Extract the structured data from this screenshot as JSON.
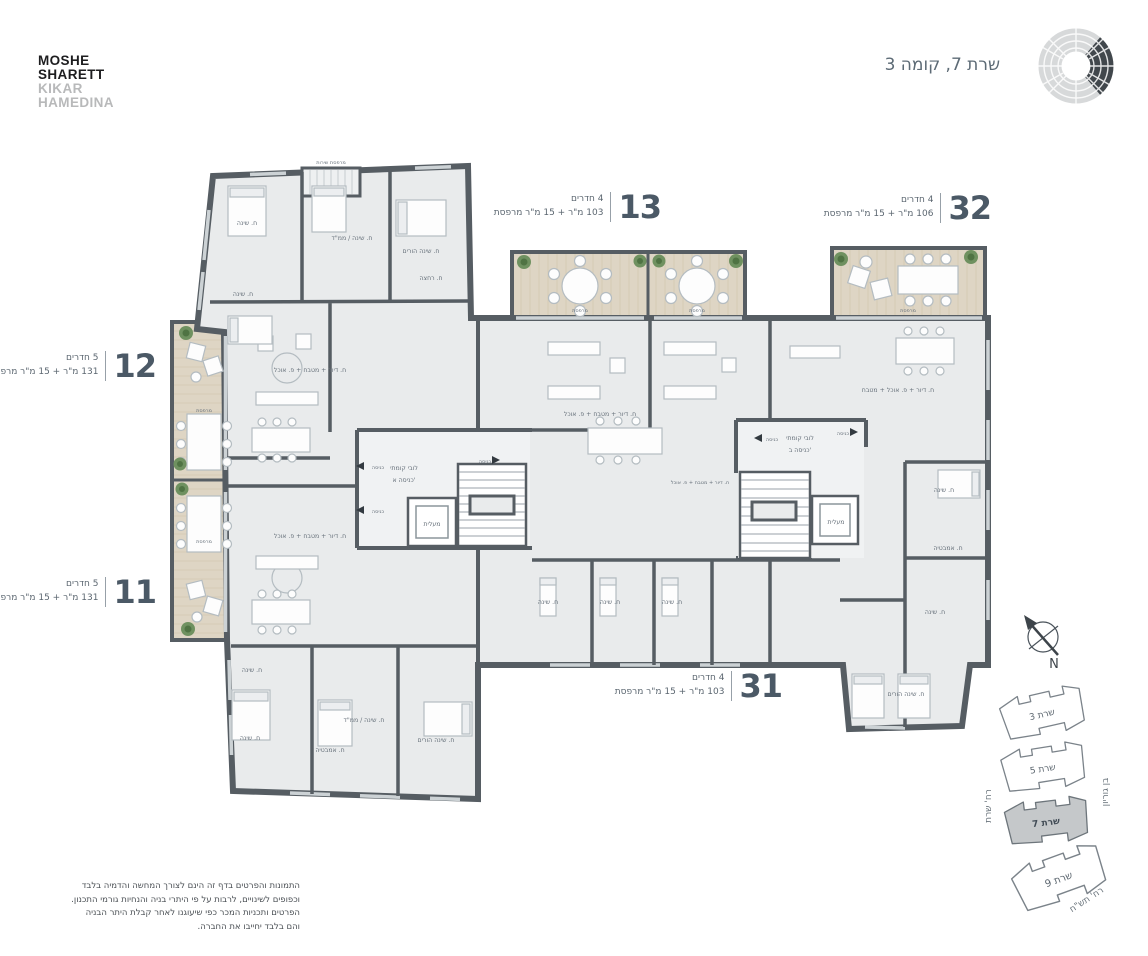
{
  "header": {
    "logo": {
      "line1": "MOSHE",
      "line2": "SHARETT",
      "line3": "KIKAR",
      "line4": "HAMEDINA"
    },
    "floor_title": "שרת 7, קומה 3"
  },
  "units": {
    "u12": {
      "number": "12",
      "rooms": "5 חדרים",
      "area": "131 מ\"ר + 15 מ\"ר מרפסת"
    },
    "u11": {
      "number": "11",
      "rooms": "5 חדרים",
      "area": "131 מ\"ר + 15 מ\"ר מרפסת"
    },
    "u13": {
      "number": "13",
      "rooms": "4 חדרים",
      "area": "103 מ\"ר + 15 מ\"ר מרפסת"
    },
    "u32": {
      "number": "32",
      "rooms": "4 חדרים",
      "area": "106 מ\"ר + 15 מ\"ר מרפסת"
    },
    "u31": {
      "number": "31",
      "rooms": "4 חדרים",
      "area": "103 מ\"ר + 15 מ\"ר מרפסת"
    }
  },
  "plan": {
    "room_labels": [
      {
        "t": "ח. שינה",
        "x": 247,
        "y": 225
      },
      {
        "t": "ח. שינה / ממ\"ד",
        "x": 352,
        "y": 240
      },
      {
        "t": "ח. שינה הורים",
        "x": 421,
        "y": 253
      },
      {
        "t": "ח. רחצה",
        "x": 431,
        "y": 280
      },
      {
        "t": "ח. שינה",
        "x": 243,
        "y": 296
      },
      {
        "t": "ח. דיור + מטבח + פ. אוכל",
        "x": 310,
        "y": 372
      },
      {
        "t": "ח. דיור + מטבח + פ. אוכל",
        "x": 310,
        "y": 538
      },
      {
        "t": "ח. שינה",
        "x": 252,
        "y": 672
      },
      {
        "t": "ח. שינה",
        "x": 250,
        "y": 740
      },
      {
        "t": "ח. אמבטיה",
        "x": 330,
        "y": 752
      },
      {
        "t": "ח. שינה / ממ\"ד",
        "x": 364,
        "y": 722
      },
      {
        "t": "ח. שינה הורים",
        "x": 436,
        "y": 742
      },
      {
        "t": "ח. דיור + מטבח + פ. אוכל",
        "x": 600,
        "y": 416
      },
      {
        "t": "ח. שינה",
        "x": 548,
        "y": 604
      },
      {
        "t": "ח. שינה",
        "x": 610,
        "y": 604
      },
      {
        "t": "ח. שינה",
        "x": 672,
        "y": 604
      },
      {
        "t": "ח. דיור + מטבח + פ. אוכל",
        "x": 700,
        "y": 484,
        "s": "xs"
      },
      {
        "t": "ח. דיור + פ. אוכל + מטבח",
        "x": 898,
        "y": 392
      },
      {
        "t": "ח. שינה",
        "x": 944,
        "y": 492
      },
      {
        "t": "ח. אמבטיה",
        "x": 948,
        "y": 550
      },
      {
        "t": "ח. שינה",
        "x": 935,
        "y": 614
      },
      {
        "t": "ח. שינה הורים",
        "x": 906,
        "y": 696
      },
      {
        "t": "מרפסת",
        "x": 580,
        "y": 312,
        "s": "xs"
      },
      {
        "t": "מרפסת",
        "x": 697,
        "y": 312,
        "s": "xs"
      },
      {
        "t": "מרפסת",
        "x": 908,
        "y": 312,
        "s": "xs"
      },
      {
        "t": "מרפסת",
        "x": 204,
        "y": 412,
        "s": "xs"
      },
      {
        "t": "מרפסת",
        "x": 204,
        "y": 543,
        "s": "xs"
      },
      {
        "t": "מרפסת שירות",
        "x": 331,
        "y": 164,
        "s": "xs"
      },
      {
        "t": "מעלית",
        "x": 432,
        "y": 526
      },
      {
        "t": "מעלית",
        "x": 836,
        "y": 524
      },
      {
        "t": "לובי קומתי",
        "x": 404,
        "y": 470
      },
      {
        "t": "כניסה א'",
        "x": 404,
        "y": 482
      },
      {
        "t": "לובי קומתי",
        "x": 800,
        "y": 440
      },
      {
        "t": "כניסה ב'",
        "x": 800,
        "y": 452
      },
      {
        "t": "כניסה",
        "x": 378,
        "y": 469,
        "s": "xs"
      },
      {
        "t": "כניסה",
        "x": 378,
        "y": 513,
        "s": "xs"
      },
      {
        "t": "כניסה",
        "x": 485,
        "y": 463,
        "s": "xs"
      },
      {
        "t": "כניסה",
        "x": 772,
        "y": 441,
        "s": "xs"
      },
      {
        "t": "כניסה",
        "x": 843,
        "y": 435,
        "s": "xs"
      }
    ]
  },
  "compass": {
    "north_label": "N"
  },
  "keyplan": {
    "buildings": [
      {
        "name": "שרת 3",
        "active": false
      },
      {
        "name": "שרת 5",
        "active": false
      },
      {
        "name": "שרת 7",
        "active": true
      },
      {
        "name": "שרת 9",
        "active": false
      }
    ],
    "streets": {
      "left": "רח' שרת",
      "right": "בן גוריון",
      "bottom": "רח' תש\"ח"
    }
  },
  "disclaimer": {
    "lines": [
      "התמונות והפרטים בדף זה הינם לצורך המחשה והדמיה בלבד",
      "וכפופים לשינויים, לרבות על פי היתרי בניה והנחיות גורמי התכנון.",
      "הפרטים ותכניות המכר כפי שיעוגנו לאחר קבלת היתר הבניה",
      "והם בלבד יחייבו את החברה."
    ]
  },
  "colors": {
    "wall": "#565d63",
    "room": "#e9ebec",
    "wood": "#ded5c4",
    "accent": "#4b5966",
    "plant": "#5d8050"
  }
}
